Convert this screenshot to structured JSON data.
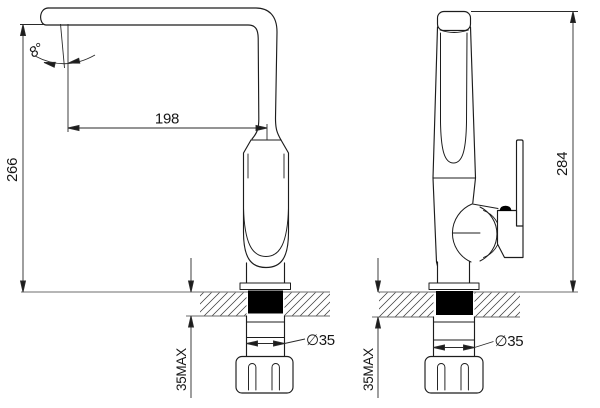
{
  "drawing": {
    "type": "faucet installation technical drawing",
    "dimensions": {
      "spout_reach": "198",
      "deck_to_spout_height": "266",
      "overall_height": "284",
      "spout_tilt_angle": "8°",
      "hole_diameter_left": "∅35",
      "hole_diameter_right": "∅35",
      "deck_thickness_max_left": "35MAX",
      "deck_thickness_max_right": "35MAX"
    },
    "colors": {
      "line": "#1c1c1c",
      "counter_line": "#8a8a8a",
      "mount_block": "#000000",
      "background": "#ffffff"
    }
  }
}
